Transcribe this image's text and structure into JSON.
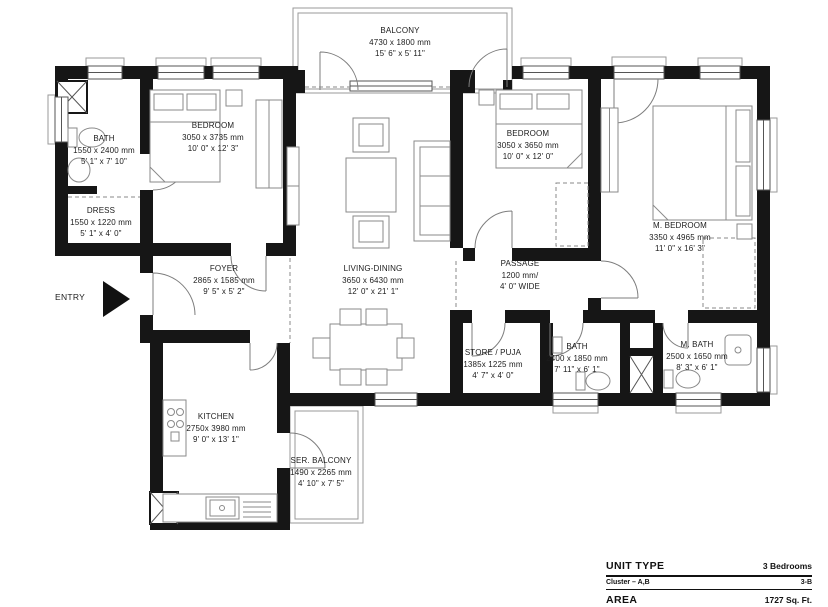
{
  "plan": {
    "entry_label": "ENTRY",
    "rooms": [
      {
        "id": "balcony",
        "name": "BALCONY",
        "dim_mm": "4730 x 1800 mm",
        "dim_ft": "15' 6\" x 5' 11\""
      },
      {
        "id": "bedroom-left",
        "name": "BEDROOM",
        "dim_mm": "3050 x 3735 mm",
        "dim_ft": "10' 0\" x 12' 3\""
      },
      {
        "id": "bath-top",
        "name": "BATH",
        "dim_mm": "1550 x 2400 mm",
        "dim_ft": "5' 1\" x 7' 10\""
      },
      {
        "id": "dress",
        "name": "DRESS",
        "dim_mm": "1550 x 1220 mm",
        "dim_ft": "5' 1\" x 4' 0\""
      },
      {
        "id": "foyer",
        "name": "FOYER",
        "dim_mm": "2865 x 1585 mm",
        "dim_ft": "9' 5\" x 5' 2\""
      },
      {
        "id": "living-dining",
        "name": "LIVING-DINING",
        "dim_mm": "3650 x 6430 mm",
        "dim_ft": "12' 0\" x 21' 1\""
      },
      {
        "id": "bedroom-mid",
        "name": "BEDROOM",
        "dim_mm": "3050 x 3650 mm",
        "dim_ft": "10' 0\" x 12' 0\""
      },
      {
        "id": "m-bedroom",
        "name": "M. BEDROOM",
        "dim_mm": "3350 x 4965 mm",
        "dim_ft": "11' 0\" x 16' 3\""
      },
      {
        "id": "passage",
        "name": "PASSAGE",
        "dim_mm": "1200 mm/",
        "dim_ft": "4' 0\" WIDE"
      },
      {
        "id": "store-puja",
        "name": "STORE / PUJA",
        "dim_mm": "1385x 1225 mm",
        "dim_ft": "4' 7\" x 4' 0\""
      },
      {
        "id": "bath-mid",
        "name": "BATH",
        "dim_mm": "2400 x 1850 mm",
        "dim_ft": "7' 11\" x 6' 1\""
      },
      {
        "id": "m-bath",
        "name": "M. BATH",
        "dim_mm": "2500 x 1650 mm",
        "dim_ft": "8' 3\" x 6' 1\""
      },
      {
        "id": "kitchen",
        "name": "KITCHEN",
        "dim_mm": "2750x 3980 mm",
        "dim_ft": "9' 0\" x 13' 1\""
      },
      {
        "id": "ser-balcony",
        "name": "SER. BALCONY",
        "dim_mm": "1490 x 2265 mm",
        "dim_ft": "4' 10\" x 7' 5\""
      }
    ]
  },
  "legend": {
    "unit_type_label": "UNIT TYPE",
    "unit_type_value": "3 Bedrooms",
    "cluster_label": "Cluster – A,B",
    "cluster_value": "3-B",
    "area_label": "AREA",
    "area_value": "1727 Sq. Ft."
  },
  "colors": {
    "wall": "#161616",
    "furniture_line": "#8a8a8a",
    "text": "#1c1c1c",
    "background": "#ffffff"
  }
}
